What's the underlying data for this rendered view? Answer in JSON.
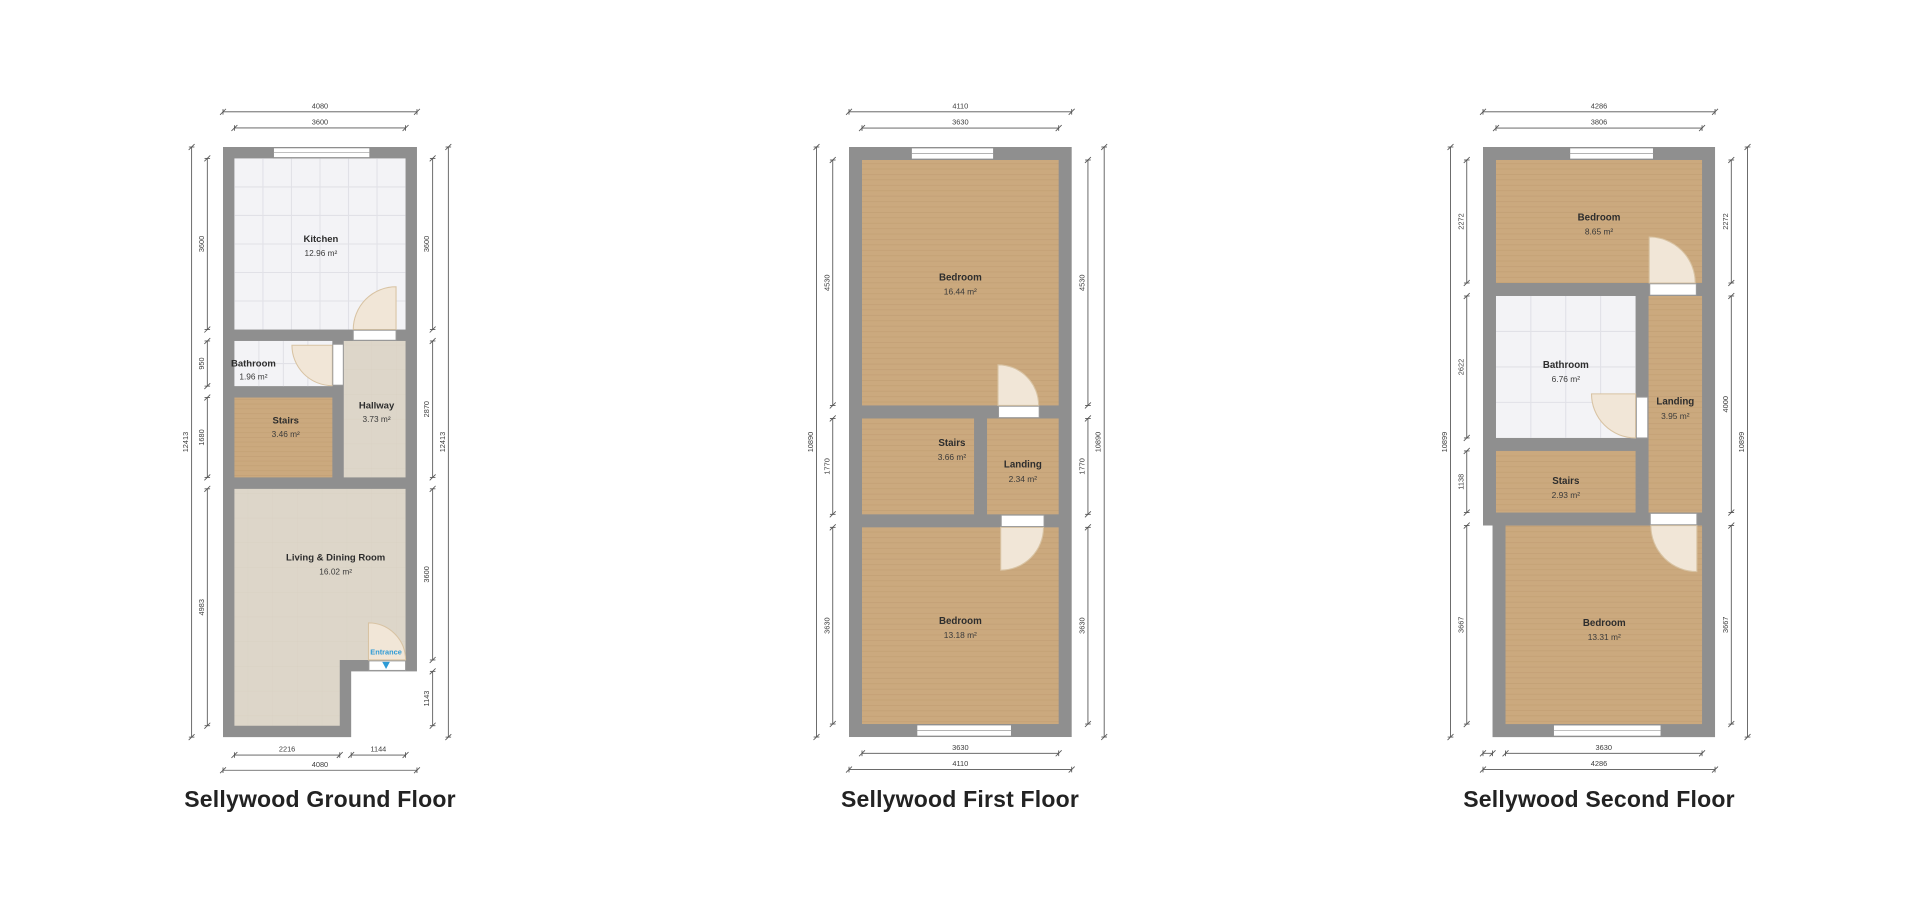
{
  "page": {
    "background": "#ffffff"
  },
  "colors": {
    "wall": "#8f8f8f",
    "wood_floor": "#cba97e",
    "beige_floor": "#ddd6c9",
    "tile_floor": "#f3f3f6",
    "door_arc": "#f1e6d7",
    "entrance_blue": "#2e9bd6",
    "dimension_text": "#3d3d3d",
    "title_text": "#222222"
  },
  "floors": [
    {
      "id": "ground",
      "title": "Sellywood Ground Floor",
      "rooms": [
        {
          "name": "Kitchen",
          "area": "12.96 m²"
        },
        {
          "name": "Bathroom",
          "area": "1.96 m²"
        },
        {
          "name": "Stairs",
          "area": "3.46 m²"
        },
        {
          "name": "Hallway",
          "area": "3.73 m²"
        },
        {
          "name": "Living & Dining Room",
          "area": "16.02 m²"
        }
      ],
      "entrance_label": "Entrance",
      "dims": {
        "top_overall": "4080",
        "top_inner": [
          "3600"
        ],
        "left_overall": "12413",
        "left_segments": [
          "3600",
          "950",
          "1680",
          "4983"
        ],
        "right_overall": "12413",
        "right_segments": [
          "3600",
          "2870",
          "3600",
          "1143"
        ],
        "bottom_overall": "4080",
        "bottom_segments": [
          "2216",
          "1144"
        ]
      }
    },
    {
      "id": "first",
      "title": "Sellywood First Floor",
      "rooms": [
        {
          "name": "Bedroom",
          "area": "16.44 m²"
        },
        {
          "name": "Stairs",
          "area": "3.66 m²"
        },
        {
          "name": "Landing",
          "area": "2.34 m²"
        },
        {
          "name": "Bedroom",
          "area": "13.18 m²"
        }
      ],
      "dims": {
        "top_overall": "4110",
        "top_inner": [
          "3630"
        ],
        "left_overall": "10890",
        "left_segments": [
          "4530",
          "1770",
          "3630"
        ],
        "right_overall": "10890",
        "right_segments": [
          "4530",
          "1770",
          "3630"
        ],
        "bottom_overall": "4110",
        "bottom_segments": [
          "3630"
        ]
      }
    },
    {
      "id": "second",
      "title": "Sellywood Second Floor",
      "rooms": [
        {
          "name": "Bedroom",
          "area": "8.65 m²"
        },
        {
          "name": "Bathroom",
          "area": "6.76 m²"
        },
        {
          "name": "Landing",
          "area": "3.95 m²"
        },
        {
          "name": "Stairs",
          "area": "2.93 m²"
        },
        {
          "name": "Bedroom",
          "area": "13.31 m²"
        }
      ],
      "dims": {
        "top_overall": "4286",
        "top_inner": [
          "3806"
        ],
        "left_overall": "10899",
        "left_segments": [
          "2272",
          "2622",
          "1138",
          "3667"
        ],
        "right_overall": "10899",
        "right_segments": [
          "2272",
          "4000",
          "3667"
        ],
        "bottom_overall": "4286",
        "bottom_segments": [
          "3630"
        ],
        "bottom_tiny": ""
      }
    }
  ]
}
